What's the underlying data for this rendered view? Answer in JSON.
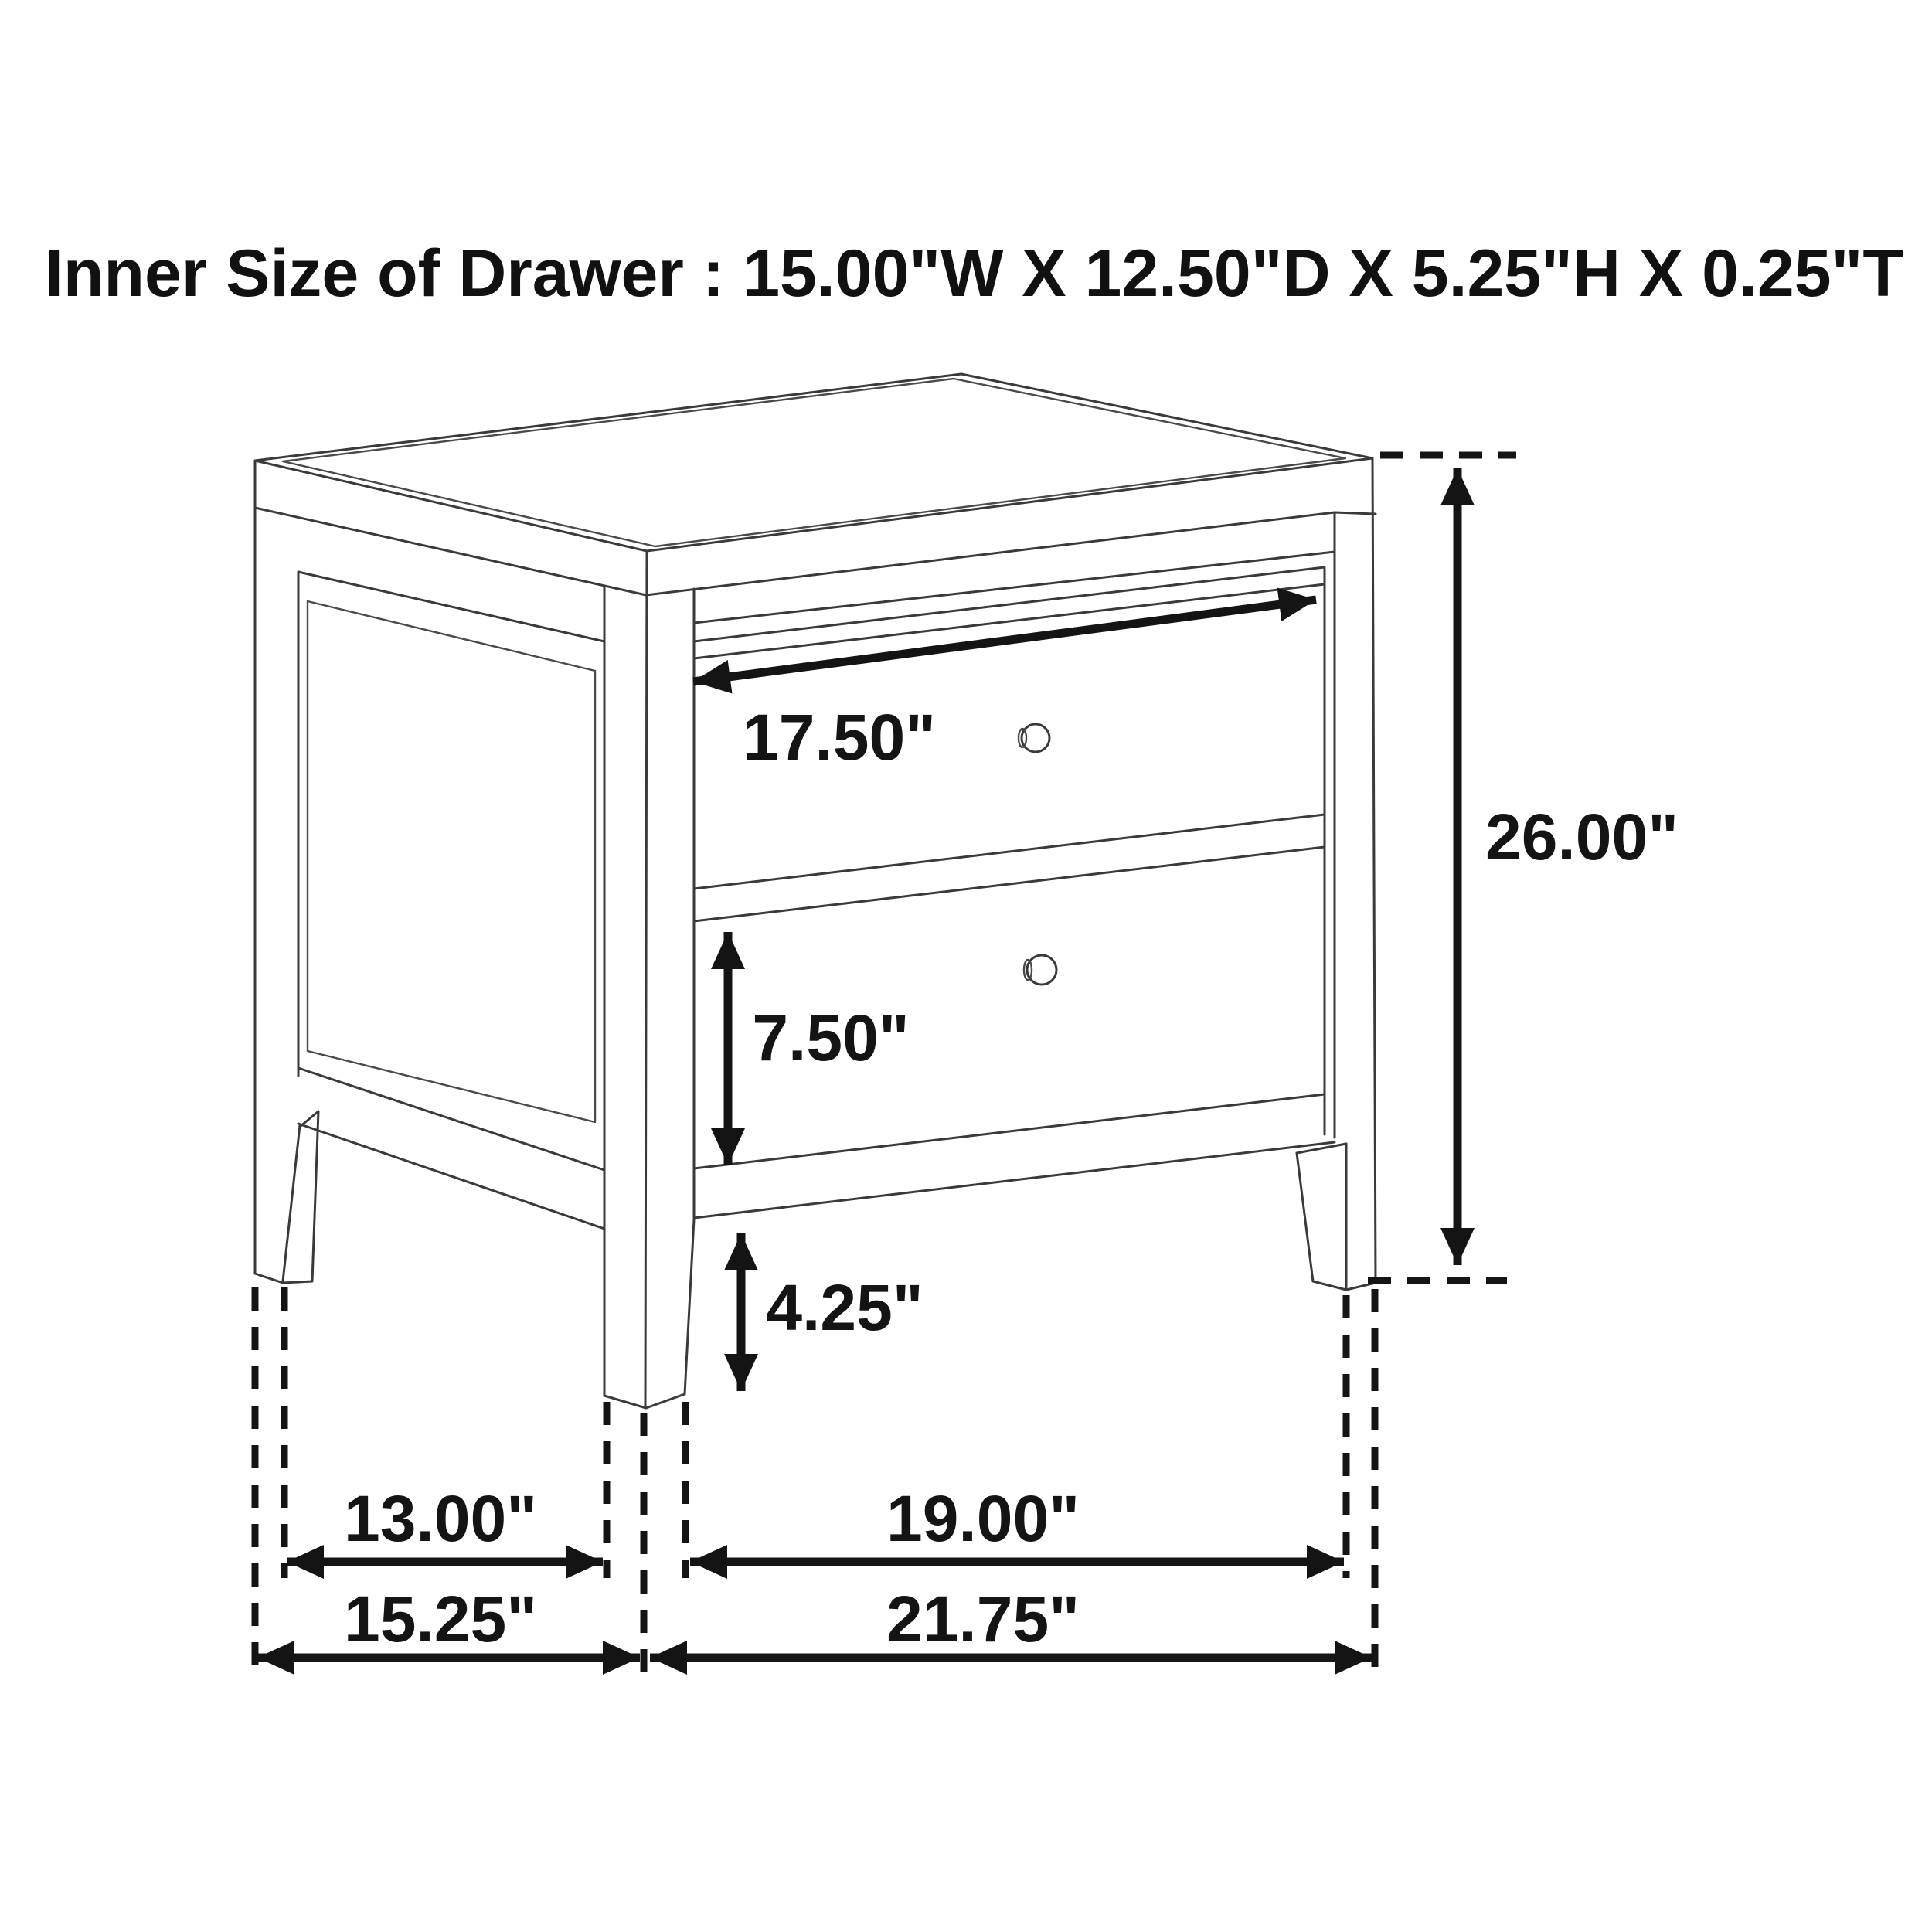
{
  "title": "Inner Size of Drawer : 15.00\"W X 12.50\"D X 5.25\"H X 0.25\"T",
  "diagram": {
    "subject": "two-drawer nightstand dimension drawing",
    "view": "front-left perspective line drawing",
    "background_color": "#ffffff",
    "line_color": "#3a3a3a",
    "dimension_color": "#141414",
    "drawer_count": 2,
    "knob_count": 2,
    "dimensions": {
      "drawer_opening_width": "17.50\"",
      "drawer_front_height": "7.50\"",
      "floor_clearance": "4.25\"",
      "overall_height": "26.00\"",
      "side_leg_spacing": "13.00\"",
      "front_leg_spacing": "19.00\"",
      "side_overall_depth": "15.25\"",
      "front_overall_width": "21.75\""
    }
  }
}
